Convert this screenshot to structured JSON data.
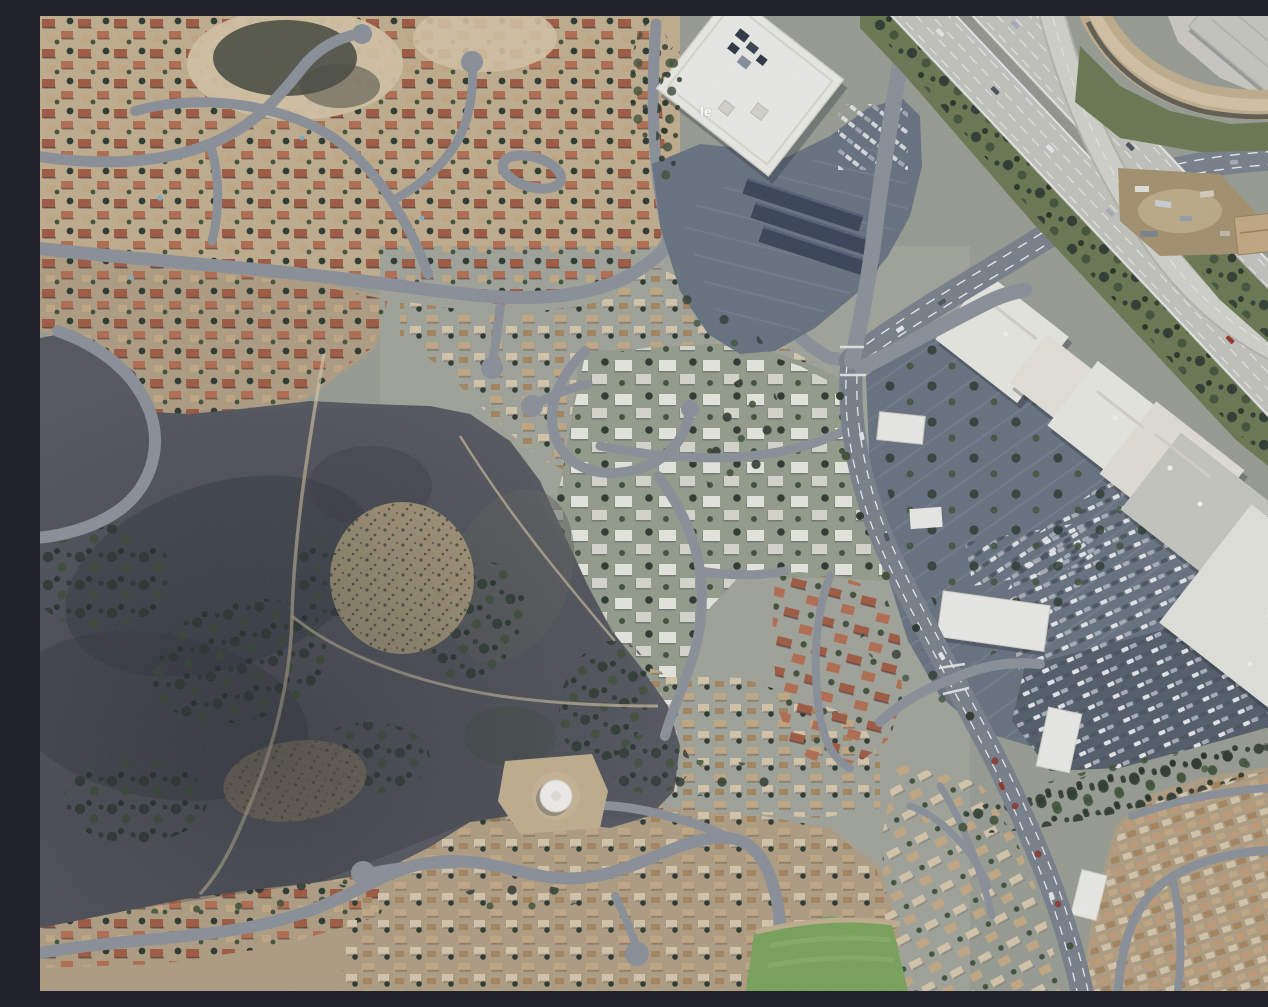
{
  "map": {
    "view": "satellite",
    "zoom_context": "aerial orthographic imagery, suburban scale",
    "description": "Aerial satellite view of a suburban area: red-roofed residential neighborhoods northwest and south, a white office building with solar carport parking at top center, a freeway interchange at top right, a big-box shopping center with tree-dotted parking on the right, dense white condominium clusters in the center, a dark chaparral hillside open space on the left with dirt trails, a white circular water tank, and a green sports field at the bottom",
    "watermark_fragment": "le",
    "palette": {
      "base": "#9ba095",
      "tan": "#c6b190",
      "tan2": "#b4a184",
      "tan3": "#d9c7a6",
      "dirt": "#a8946f",
      "scrub": "#4b4d42",
      "hill": "#56585f",
      "hill2": "#3b3e44",
      "trees": "#2d392f",
      "trees2": "#415239",
      "verge": "#6d7a52",
      "grass": "#7da65c",
      "road": "#8e939b",
      "road2": "#7b828d",
      "fwy": "#c8c7c0",
      "fwy2": "#d7d6cf",
      "white_line": "#f0f1ef",
      "roof_red": "#a35b42",
      "roof_red2": "#b76f51",
      "roof_tan": "#c8ab85",
      "roof_tan2": "#aa875f",
      "roof_beige": "#dbcbae",
      "roof_white": "#edece5",
      "roof_white2": "#dedcd2",
      "bldg_white": "#f1f0ea",
      "bldg_gray": "#cbcac3",
      "parking": "#6a7381",
      "parking2": "#555e6b",
      "rowline": "#8a94a2",
      "solar": "#3a4457",
      "car1": "#eaebed",
      "car2": "#aab1ba",
      "car3": "#4d5560",
      "car_red": "#963527",
      "tank": "#f5f3ed",
      "speckle": "#c0ad85",
      "shadow": "#1d2430",
      "tint": "#2b3550"
    },
    "features": [
      {
        "id": "neighborhood-northwest",
        "label": "Residential neighborhood with red tile roofs and curving streets",
        "kind": "residential"
      },
      {
        "id": "office-building",
        "label": "Large white-roofed office building",
        "kind": "commercial"
      },
      {
        "id": "solar-carports",
        "label": "Dark solar panel carport rows in office parking lot",
        "kind": "infrastructure"
      },
      {
        "id": "freeway",
        "label": "Multi-lane freeway running diagonally through top right",
        "kind": "road"
      },
      {
        "id": "freeway-ramp",
        "label": "Elevated interchange ramp crossing the freeway",
        "kind": "road"
      },
      {
        "id": "avenue",
        "label": "Arterial avenue passing under the freeway toward the east",
        "kind": "road"
      },
      {
        "id": "arterial-south",
        "label": "Arterial road curving south past the shopping center",
        "kind": "road"
      },
      {
        "id": "collector-street",
        "label": "Collector street winding west through neighborhoods",
        "kind": "road"
      },
      {
        "id": "shopping-center",
        "label": "Row of big-box retail stores with white and gray roofs",
        "kind": "commercial"
      },
      {
        "id": "shopping-parking",
        "label": "Large parking lots with tree islands and many parked cars",
        "kind": "parking"
      },
      {
        "id": "outparcel-buildings",
        "label": "Small white commercial pad buildings along the arterial",
        "kind": "commercial"
      },
      {
        "id": "hillside-open-space",
        "label": "Dark undeveloped chaparral hillside with brush and shadows",
        "kind": "terrain"
      },
      {
        "id": "brush-speckle",
        "label": "Tan speckled brush patches on hillside",
        "kind": "terrain"
      },
      {
        "id": "dirt-trails",
        "label": "Light dirt trails crossing the hillside",
        "kind": "terrain"
      },
      {
        "id": "water-tank",
        "label": "White circular water tank on graded dirt pad",
        "kind": "infrastructure"
      },
      {
        "id": "condos-center",
        "label": "Dense white-roofed condominium clusters",
        "kind": "residential"
      },
      {
        "id": "condos-red",
        "label": "Red tile roofed condominium complex west of arterial",
        "kind": "residential"
      },
      {
        "id": "townhomes",
        "label": "Beige townhome complex southwest of arterial",
        "kind": "residential"
      },
      {
        "id": "tract-southeast",
        "label": "Dense tract-home subdivision in southeast corner",
        "kind": "residential"
      },
      {
        "id": "neighborhood-south",
        "label": "Residential band with winding streets and cul-de-sacs along bottom",
        "kind": "residential"
      },
      {
        "id": "sports-field",
        "label": "Green grass field at bottom center",
        "kind": "park"
      },
      {
        "id": "staging-area",
        "label": "Dirt construction staging area with trucks near interchange",
        "kind": "industrial"
      },
      {
        "id": "industrial-northeast",
        "label": "Gray-roofed industrial building in top right corner",
        "kind": "industrial"
      },
      {
        "id": "dirt-berm",
        "label": "Curved tan dirt berm northeast of the freeway",
        "kind": "terrain"
      }
    ]
  }
}
